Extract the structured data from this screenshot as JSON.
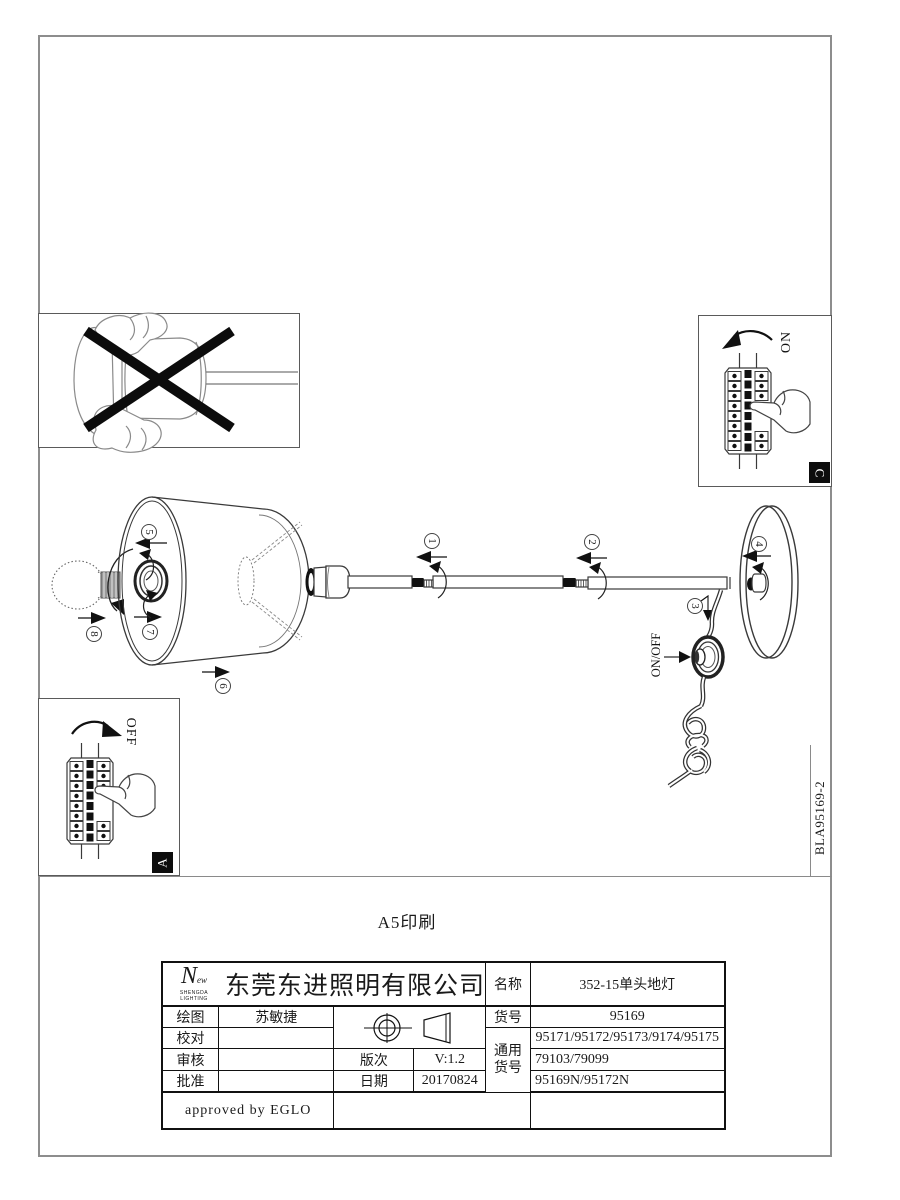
{
  "page": {
    "print_note": "A5印刷",
    "drawing_code": "BLA95169-2"
  },
  "boxes": {
    "on_label": "ON",
    "on_letter": "C",
    "off_label": "OFF",
    "off_letter": "A",
    "switch_label": "ON/OFF"
  },
  "callouts": [
    "1",
    "2",
    "3",
    "4",
    "5",
    "6",
    "7",
    "8"
  ],
  "title_block": {
    "logo_script": "N",
    "logo_script_suffix": "ew",
    "logo_line1": "SHENGDA",
    "logo_line2": "LIGHTING",
    "company": "东莞东进照明有限公司",
    "name_label": "名称",
    "name_value": "352-15单头地灯",
    "item_label": "货号",
    "item_value": "95169",
    "common_label_1": "通用",
    "common_label_2": "货号",
    "common_value_1": "95171/95172/95173/9174/95175",
    "common_value_2": "79103/79099",
    "common_value_3": "95169N/95172N",
    "draw_label": "绘图",
    "draw_value": "苏敏捷",
    "check_label": "校对",
    "review_label": "审核",
    "approve_label": "批准",
    "version_label": "版次",
    "version_value": "V:1.2",
    "date_label": "日期",
    "date_value": "20170824",
    "approved_note": "approved by EGLO"
  }
}
